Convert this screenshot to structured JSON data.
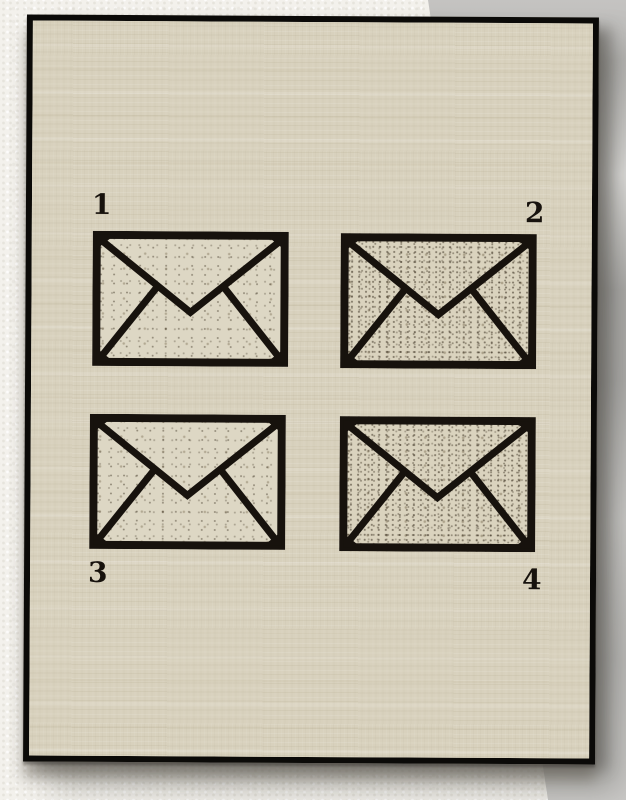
{
  "scene": {
    "description": "Photo of a black-framed linen-canvas print showing four numbered envelope icons",
    "wall_color": "#f3f1ec",
    "backdrop_color": "#b2b1af"
  },
  "frame": {
    "border_color": "#0b0a08",
    "canvas_color": "#d8d1bd"
  },
  "print": {
    "ink_color": "#17120d",
    "labels": [
      {
        "text": "1",
        "position": "top-left"
      },
      {
        "text": "2",
        "position": "top-right"
      },
      {
        "text": "3",
        "position": "bottom-left"
      },
      {
        "text": "4",
        "position": "bottom-right"
      }
    ],
    "envelopes": [
      {
        "name": "envelope-1",
        "texture": "light"
      },
      {
        "name": "envelope-2",
        "texture": "dense"
      },
      {
        "name": "envelope-3",
        "texture": "light"
      },
      {
        "name": "envelope-4",
        "texture": "dense"
      }
    ]
  }
}
